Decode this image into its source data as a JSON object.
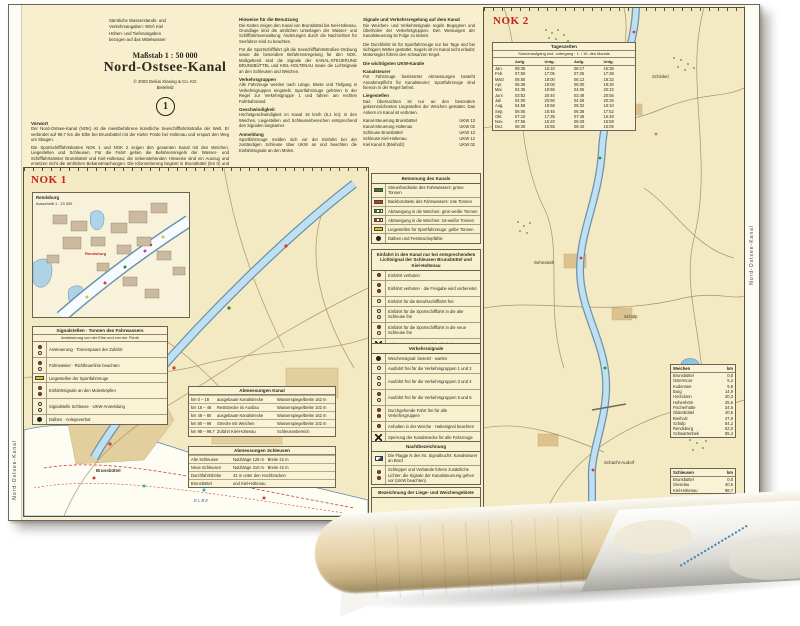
{
  "chart": {
    "margin_left_text": "Nord-Ostsee-Kanal",
    "margin_right_text": "Nord-Ostsee-Kanal",
    "title_block": {
      "issuer_a": [
        "Sämtliche Wasserstands- und",
        "Verkehrsangaben: WSÄ Kiel"
      ],
      "issuer_b": [
        "Höhen- und Tiefenangaben",
        "bezogen auf das Mittelwasser"
      ],
      "scale": "Maßstab 1 : 50 000",
      "title": "Nord-Ostsee-Kanal",
      "copyright": "© 2003 Delius Klasing & Co. KG",
      "place": "Bielefeld",
      "badge": "1"
    },
    "intro": {
      "heading": "Vorwort",
      "paragraphs": [
        "Der Nord-Ostsee-Kanal (NOK) ist die meistbefahrene künstliche Seeschifffahrtsstraße der Welt. Er verbindet auf 98,7 km die Elbe bei Brunsbüttel mit der Kieler Förde bei Holtenau und erspart den Weg um Skagen.",
        "Die Sportschifffahrtskarten NOK 1 und NOK 2 zeigen den gesamten Kanal mit den Weichen, Liegestellen und Schleusen. Für die Fahrt gelten die Befahrensregeln der Wasser- und Schifffahrtsämter Brunsbüttel und Kiel-Holtenau; die nebenstehenden Hinweise sind ein Auszug und ersetzen nicht die amtlichen Bekanntmachungen. Die Kilometrierung beginnt in Brunsbüttel (km 0) und endet in Holtenau (km 98,7)."
      ]
    },
    "notes_col1": [
      {
        "h": "Hinweise für die Benutzung",
        "p": "Die Karten zeigen den Kanal von Brunsbüttel bis Kiel-Holtenau. Grundlage sind die amtlichen Unterlagen der Wasser- und Schifffahrtsverwaltung; Änderungen durch die Nachrichten für Seefahrer sind zu beachten."
      },
      {
        "h": "",
        "p": "Für die Sportschifffahrt gilt die Seeschifffahrtsstraßen-Ordnung sowie die besondere Befahrensregelung für den NOK. Maßgebend sind die Signale der KANAL-STEUERUNG BRUNSBÜTTEL und KIEL-HOLTENAU sowie die Lichtsignale an den Schleusen und Weichen."
      },
      {
        "h": "Verkehrsgruppen",
        "p": "Alle Fahrzeuge werden nach Länge, Breite und Tiefgang in Verkehrsgruppen eingeteilt. Sportfahrzeuge gehören in der Regel zur Verkehrsgruppe 1 und fahren am rechten Fahrbahnrand."
      },
      {
        "h": "Geschwindigkeit",
        "p": "Höchstgeschwindigkeit im Kanal 15 km/h (8,1 kn); in den Weichen, Liegestellen und Schleusenbereichen entsprechend den Signalen langsamer."
      },
      {
        "h": "Anmeldung",
        "p": "Sportfahrzeuge melden sich vor der Einfahrt bei der zuständigen Schleuse über UKW an und beachten die Einfahrtsignale an den Molen."
      }
    ],
    "notes_col2": [
      {
        "h": "Signale und Verkehrsregelung auf dem Kanal",
        "p": "Die Weichen- und Verkehrssignale regeln Begegnen und Überholen der Verkehrsgruppen. Den Weisungen der Kanalsteuerung ist Folge zu leisten."
      },
      {
        "h": "",
        "p": "Die Durchfahrt ist für Sportfahrzeuge nur bei Tage und bei sichtigem Wetter gestattet. Segeln ist im Kanal nicht erlaubt; Motorsegler führen den schwarzen Kegel."
      },
      {
        "h": "Die wichtigsten UKW-Kanäle",
        "p": ""
      },
      {
        "h": "Kanalsteurer",
        "p": "Für Fahrzeuge bestimmter Abmessungen besteht Annahmepflicht für Kanalsteurer; Sportfahrzeuge sind hiervon in der Regel befreit."
      },
      {
        "h": "Liegestellen",
        "p": "Das Übernachten ist nur an den besonders gekennzeichneten Liegestellen der Weichen gestattet. Das Ankern im Kanal ist verboten."
      }
    ],
    "radio": [
      {
        "l": "Kanal-Steuerung Brunsbüttel",
        "r": "UKW 13"
      },
      {
        "l": "Kanal-Steuerung Holtenau",
        "r": "UKW 02"
      },
      {
        "l": "Schleuse Brunsbüttel",
        "r": "UKW 13"
      },
      {
        "l": "Schleuse Kiel-Holtenau",
        "r": "UKW 12"
      },
      {
        "l": "Kiel Kanal II (Breiholz)",
        "r": "UKW 02"
      }
    ],
    "nok1": {
      "label": "NOK 1",
      "inset_title": "Rendsburg",
      "inset_sub": "Ausschnitt 1 : 20 000",
      "inset_city": "Rendsburg",
      "label_city": "Brunsbüttel",
      "label_river": "ELBE",
      "legend_box": {
        "title": "Signalstellen · Tonnen des Fahrwassers",
        "subtitle": "Ansteuerung von der Elbe und von der Förde",
        "rows": [
          {
            "g": "g-sig-rw",
            "t": "Ansteuerung · Tonnenpaare der Zufahrt"
          },
          {
            "g": "g-sig-rw",
            "t": "Fahrwasser · Richtfeuerlinie beachten"
          },
          {
            "g": "g-yellow",
            "t": "Liegestellen der Sportfahrzeuge"
          },
          {
            "g": "g-sig-rr",
            "t": "Einfahrtsignale an den Molenköpfen"
          },
          {
            "g": "g-sig-ww",
            "t": "Signalstelle Schleuse · UKW-Anmeldung"
          },
          {
            "g": "g-dot",
            "t": "Dalben · Anlegeverbot"
          }
        ]
      },
      "tableA": {
        "title": "Abmessungen Kanal",
        "rows": [
          [
            "km 0 – 18",
            "ausgebaute Kanalstrecke",
            "Wasserspiegelbreite 162 m"
          ],
          [
            "km 18 – 48",
            "Reststrecke im Ausbau",
            "Wasserspiegelbreite 102 m"
          ],
          [
            "km 48 – 80",
            "ausgebaute Kanalstrecke",
            "Wasserspiegelbreite 162 m"
          ],
          [
            "km 80 – 98",
            "Strecke mit Weichen",
            "Wasserspiegelbreite 102 m"
          ],
          [
            "km 98 – 98,7",
            "Zufahrt Kiel-Holtenau",
            "Schleusenbereich"
          ]
        ]
      },
      "tableB": {
        "title": "Abmessungen Schleusen",
        "rows": [
          [
            "Alte Schleusen",
            "Nutzlänge 125 m · Breite 22 m"
          ],
          [
            "Neue Schleusen",
            "Nutzlänge 310 m · Breite 42 m"
          ],
          [
            "Durchfahrtshöhe",
            "42 m unter den Hochbrücken"
          ],
          [
            "Brunsbüttel",
            "und Kiel-Holtenau"
          ]
        ]
      }
    },
    "legend": {
      "s1": {
        "header": "Betonnung des Kanals",
        "rows": [
          {
            "g": "g-green",
            "t": "Steuerbordseite des Fahrwassers: grüne Tonnen"
          },
          {
            "g": "g-red",
            "t": "Backbordseite des Fahrwassers: rote Tonnen"
          },
          {
            "g": "g-greenw",
            "t": "Abzweigung in die Weichen: grün-weiße Tonnen"
          },
          {
            "g": "g-redw",
            "t": "Abzweigung in die Weichen: rot-weiße Tonnen"
          },
          {
            "g": "g-yellow",
            "t": "Liegestellen für Sportfahrzeuge: gelbe Tonnen"
          },
          {
            "g": "g-dot",
            "t": "Dalben und Festmachepfähle"
          }
        ]
      },
      "s2": {
        "header": "Einfahrt in den Kanal nur bei entsprechendem Lichtsignal der Schleusen Brunsbüttel und Kiel-Holtenau",
        "rows": [
          {
            "g": "g-sig-r",
            "t": "Einfahrt verboten"
          },
          {
            "g": "g-sig-rr",
            "t": "Einfahrt verboten · die Freigabe wird vorbereitet"
          },
          {
            "g": "g-sig-w",
            "t": "Einfahrt für die Berufsschifffahrt frei"
          },
          {
            "g": "g-sig-ww",
            "t": "Einfahrt für die Sportschifffahrt in die alte Schleuse frei"
          },
          {
            "g": "g-sig-rw",
            "t": "Einfahrt für die Sportschifffahrt in die neue Schleuse frei"
          },
          {
            "g": "g-x",
            "t": "Schleuse gesperrt · Einfahrt freihalten"
          }
        ]
      },
      "s3": {
        "header": "Verkehrssignale",
        "rows": [
          {
            "g": "g-dot",
            "t": "Weichensignal: besetzt · warten"
          },
          {
            "g": "g-sig-w",
            "t": "Ausfahrt frei für die Verkehrsgruppen 1 und 2"
          },
          {
            "g": "g-sig-ww",
            "t": "Ausfahrt frei für die Verkehrsgruppen 3 und 4"
          },
          {
            "g": "g-sig-rw",
            "t": "Ausfahrt frei für die Verkehrsgruppen 5 und 6"
          },
          {
            "g": "g-sig-rr",
            "t": "Durchgehende Fahrt frei für alle Verkehrsgruppen"
          },
          {
            "g": "g-sig-r",
            "t": "Anhalten in der Weiche · Haltesignal beachten"
          },
          {
            "g": "g-x",
            "t": "Sperrung der Kanalstrecke für alle Fahrzeuge"
          },
          {
            "g": "g-x",
            "t": "Sperrung der Weicheneinfahrt"
          }
        ]
      },
      "s4": {
        "header": "Nachtbezeichnung",
        "rows": [
          {
            "g": "g-flag",
            "t": "Die Flagge N des Int. Signalbuchs: Kanalsteurer an Bord"
          },
          {
            "g": "g-sig-rr",
            "t": "Schlepper und Verbände führen zusätzliche Lichter; die Signale der Kanalsteuerung gehen vor (UKW beachten)"
          }
        ]
      },
      "s5": {
        "header": "Bezeichnung der Liege- und Weichengebiete"
      }
    },
    "nok2": {
      "label": "NOK 2",
      "labels": [
        "Schinkel",
        "Sehestedt",
        "Schülp",
        "Schacht-Audorf"
      ],
      "timetable": {
        "title": "Tageszeiten",
        "subtitle": "Sonnenaufgang und -untergang · 1. / 15. des Monats",
        "cols": [
          "",
          "Aufg.",
          "Untg.",
          "Aufg.",
          "Untg."
        ],
        "rows": [
          [
            "Jan.",
            "08:35",
            "16:10",
            "08:17",
            "16:35"
          ],
          [
            "Feb.",
            "07:50",
            "17:05",
            "07:25",
            "17:38"
          ],
          [
            "März",
            "06:50",
            "18:00",
            "06:12",
            "18:32"
          ],
          [
            "Apr.",
            "05:38",
            "19:00",
            "05:00",
            "19:30"
          ],
          [
            "Mai",
            "04:35",
            "19:55",
            "04:05",
            "20:22"
          ],
          [
            "Juni",
            "03:52",
            "20:40",
            "03:48",
            "20:55"
          ],
          [
            "Juli",
            "04:00",
            "20:50",
            "04:28",
            "20:25"
          ],
          [
            "Aug.",
            "04:58",
            "19:58",
            "05:32",
            "19:10"
          ],
          [
            "Sep.",
            "06:05",
            "18:45",
            "06:38",
            "17:52"
          ],
          [
            "Okt.",
            "07:10",
            "17:35",
            "07:45",
            "16:48"
          ],
          [
            "Nov.",
            "07:55",
            "16:20",
            "08:28",
            "15:58"
          ],
          [
            "Dez.",
            "08:30",
            "15:55",
            "08:40",
            "16:05"
          ]
        ]
      },
      "dist1": {
        "title": "Weichen",
        "unit": "km",
        "rows": [
          {
            "n": "Brunsbüttel",
            "v": "0,0"
          },
          {
            "n": "Ostermoor",
            "v": "5,2"
          },
          {
            "n": "Kudensee",
            "v": "9,8"
          },
          {
            "n": "Burg",
            "v": "14,9"
          },
          {
            "n": "Hochdonn",
            "v": "20,3"
          },
          {
            "n": "Hohenhörn",
            "v": "25,6"
          },
          {
            "n": "Fischerhütte",
            "v": "34,6"
          },
          {
            "n": "Oldenbüttel",
            "v": "40,5"
          },
          {
            "n": "Breiholz",
            "v": "47,9"
          },
          {
            "n": "Schülp",
            "v": "54,2"
          },
          {
            "n": "Rendsburg",
            "v": "62,0"
          },
          {
            "n": "Schwartenbek",
            "v": "85,4"
          }
        ]
      },
      "dist2": {
        "title": "Schleusen",
        "unit": "km",
        "rows": [
          {
            "n": "Brunsbüttel",
            "v": "0,0"
          },
          {
            "n": "Gieselau",
            "v": "40,5"
          },
          {
            "n": "Kiel-Holtenau",
            "v": "98,7"
          }
        ]
      }
    }
  }
}
